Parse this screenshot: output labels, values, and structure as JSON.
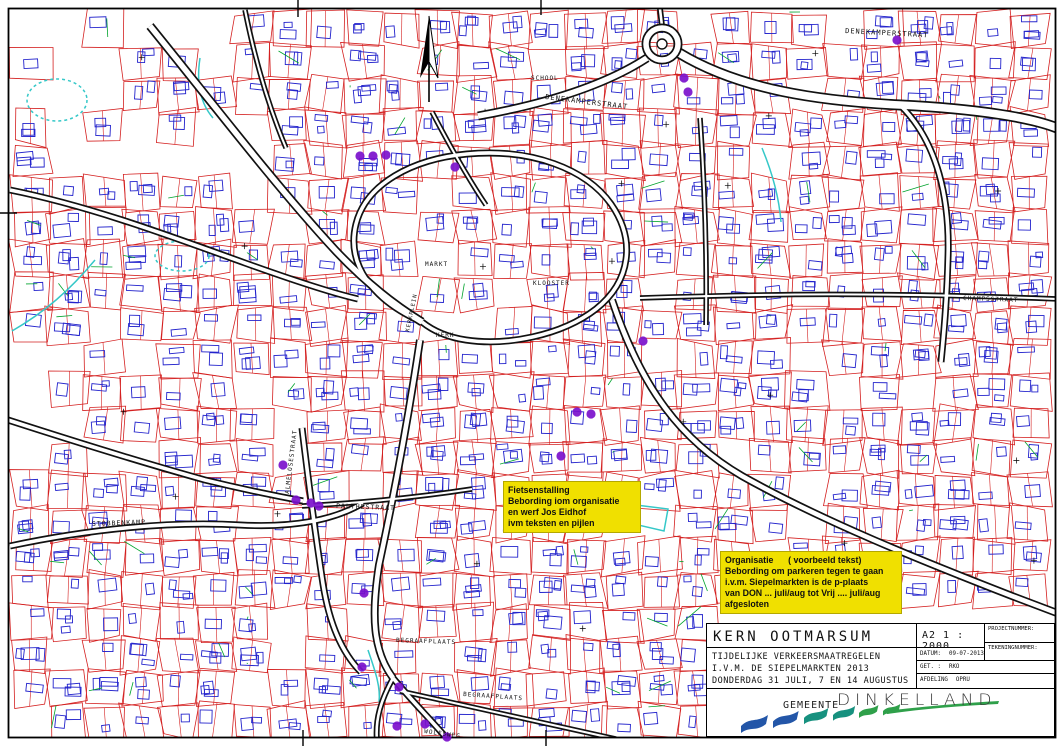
{
  "map": {
    "colors": {
      "parcel": "#d42020",
      "building": "#2323cc",
      "road": "#111111",
      "water": "#35c8c8",
      "green": "#00a32c",
      "marker": "#7b10cc",
      "note_bg": "#f0e000",
      "logo_blue": "#2356a8",
      "logo_teal": "#17917f",
      "logo_green": "#2fa04a"
    },
    "street_labels": [
      {
        "t": "DENEKAMPERSTRAAT",
        "x": 545,
        "y": 99,
        "r": 7,
        "s": 7
      },
      {
        "t": "DENEKAMPERSTRAAT",
        "x": 845,
        "y": 33,
        "r": 3,
        "s": 7
      },
      {
        "t": "SCHOOL",
        "x": 531,
        "y": 80,
        "r": 0,
        "s": 6
      },
      {
        "t": "MARKT",
        "x": 425,
        "y": 266,
        "r": 0,
        "s": 6
      },
      {
        "t": "KLOOSTER",
        "x": 533,
        "y": 285,
        "r": 0,
        "s": 6
      },
      {
        "t": "KERK",
        "x": 436,
        "y": 337,
        "r": 0,
        "s": 6
      },
      {
        "t": "KERKPLEIN",
        "x": 409,
        "y": 332,
        "r": -78,
        "s": 5.5
      },
      {
        "t": "STOBBENKAMP",
        "x": 92,
        "y": 526,
        "r": -2,
        "s": 6.5
      },
      {
        "t": "PALTHESTRAAT",
        "x": 336,
        "y": 508,
        "r": 2,
        "s": 6.5
      },
      {
        "t": "ALMELOSESTRAAT",
        "x": 289,
        "y": 494,
        "r": -83,
        "s": 6
      },
      {
        "t": "CHAMPSSTRAAT",
        "x": 963,
        "y": 300,
        "r": 2,
        "s": 6
      },
      {
        "t": "BEGRAAFPLAATS",
        "x": 396,
        "y": 642,
        "r": 2,
        "s": 6
      },
      {
        "t": "BEGRAAFPLAATS",
        "x": 463,
        "y": 696,
        "r": 4,
        "s": 6
      },
      {
        "t": "WOLFSWEG",
        "x": 424,
        "y": 733,
        "r": 8,
        "s": 6
      }
    ],
    "measure_points": [
      [
        360,
        156
      ],
      [
        373,
        156
      ],
      [
        386,
        155
      ],
      [
        455,
        167
      ],
      [
        684,
        78
      ],
      [
        688,
        92
      ],
      [
        897,
        40
      ],
      [
        643,
        341
      ],
      [
        577,
        412
      ],
      [
        591,
        414
      ],
      [
        561,
        456
      ],
      [
        283,
        465
      ],
      [
        296,
        500
      ],
      [
        311,
        503
      ],
      [
        319,
        506
      ],
      [
        364,
        593
      ],
      [
        362,
        667
      ],
      [
        399,
        687
      ],
      [
        397,
        726
      ],
      [
        425,
        724
      ],
      [
        447,
        737
      ]
    ]
  },
  "notes": [
    {
      "name": "note-fietsenstalling",
      "x": 503,
      "y": 481,
      "w": 128,
      "lines": [
        "Fietsenstalling",
        "Bebording iom organisatie",
        "en werf Jos Eidhof",
        "ivm teksten en pijlen"
      ]
    },
    {
      "name": "note-organisatie",
      "x": 720,
      "y": 551,
      "w": 172,
      "lines": [
        "Organisatie      ( voorbeeld tekst)",
        "Bebording om parkeren tegen te gaan",
        "i.v.m. Siepelmarkten is de p-plaats",
        "van DON ... juli/aug tot Vrij .... juli/aug",
        "afgesloten"
      ]
    }
  ],
  "title_block": {
    "title": "KERN OOTMARSUM",
    "sheet_scale": "A2  1 : 2000",
    "projectnummer_label": "PROJECTNUMMER:",
    "tekeningnummer_label": "TEKENINGNUMMER:",
    "description_lines": [
      "TIJDELIJKE VERKEERSMAATREGELEN",
      "I.V.M. DE SIEPELMARKTEN 2013",
      "DONDERDAG 31 JULI, 7 EN 14 AUGUSTUS"
    ],
    "datum_label": "DATUM:",
    "datum_value": "09-07-2013",
    "get_label": "GET. :",
    "get_value": "RKO",
    "afdeling_label": "AFDELING",
    "afdeling_value": "OPRU",
    "logo": {
      "gemeente": "GEMEENTE",
      "name": "DINKELLAND"
    }
  }
}
